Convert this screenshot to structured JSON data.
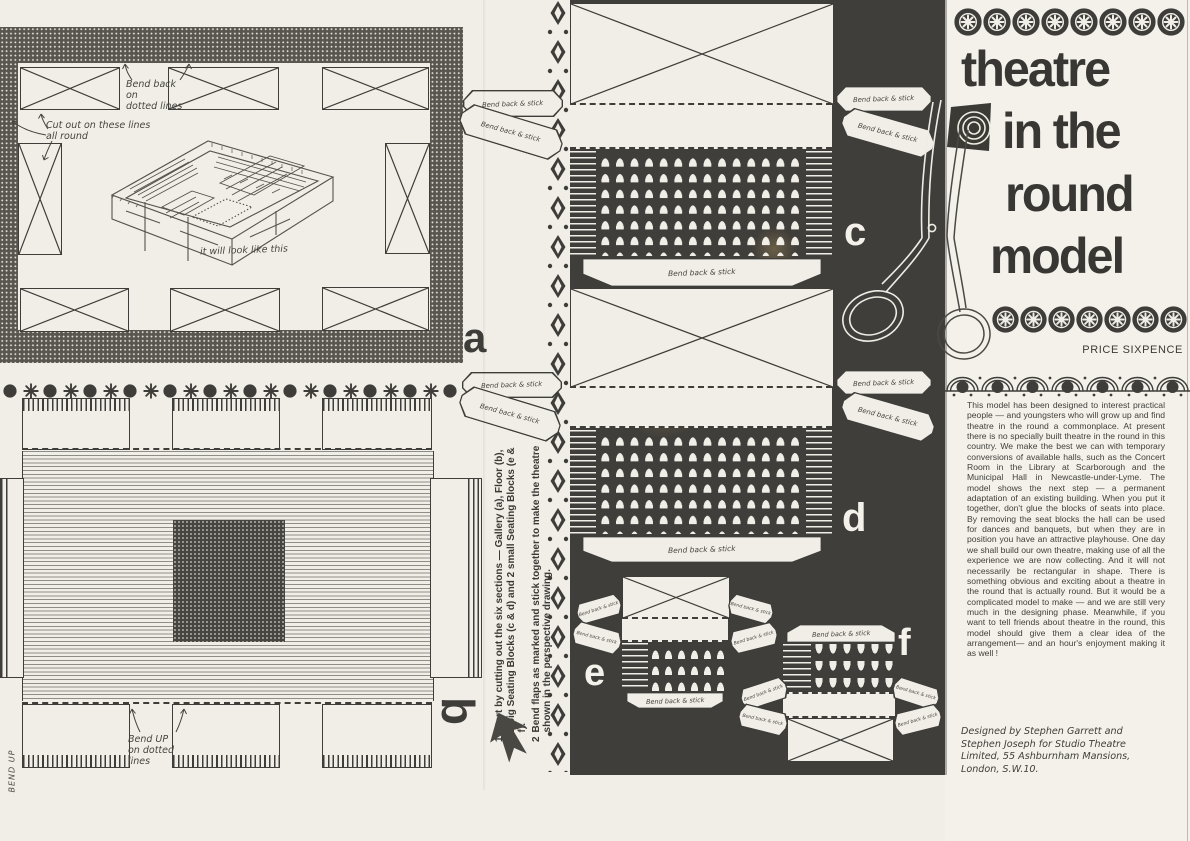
{
  "title_panel": {
    "title_lines": [
      "theatre",
      "in the",
      "round",
      "model"
    ],
    "price": "PRICE SIXPENCE",
    "body": "This model has been designed to interest practical people — and youngsters who will grow up and find theatre in the round a commonplace.  At present there is no specially built theatre in the round in this country.   We make the best we can with temporary conversions of available halls, such as the Concert Room in the Library at Scarborough and the Municipal Hall in Newcastle-under-Lyme. The model shows the next step — a permanent adaptation of an existing building.   When you put it together, don't glue the blocks of seats into place. By removing the seat blocks the hall can be used for dances and banquets, but when they are in position you have an attractive playhouse.   One day we shall build our own theatre, making use of all the experience we are now collecting. And it will not necessarily be rectangular in shape.   There is something obvious and exciting about a theatre in the round that is actually round.   But it would be a complicated model to make — and we are still very much in the designing phase.  Meanwhile, if you want to tell friends about theatre in the round, this model should give them a clear idea of the arrangement— and an hour's enjoyment making it as well !",
    "credits": "Designed by Stephen Garrett and Stephen Joseph for Studio Theatre Limited, 55 Ashburnham Mansions, London, S.W.10."
  },
  "instructions": {
    "step1_num": "1",
    "step1": "Start by cutting out the six sections — Gallery (a), Floor (b), 2 big Seating Blocks (c & d) and 2 small Seating Blocks (e & f).",
    "step2_num": "2",
    "step2": "Bend flaps as marked and stick together to make the theatre shown in the perspective drawing."
  },
  "annotations": {
    "bend_back_dotted": "Bend back\non\ndotted lines",
    "cut_out": "Cut out on these lines\nall round",
    "look_like": "it will look like this",
    "bend_up": "Bend UP\non dotted\nlines",
    "bend_up_edge": "BEND UP",
    "flap": "Bend back & stick"
  },
  "piece_labels": {
    "a": "a",
    "b": "b",
    "c": "c",
    "d": "d",
    "e": "e",
    "f": "f"
  },
  "colors": {
    "paper": "#f1eee7",
    "ink": "#3e3d39",
    "black_panel": "#403e3a"
  }
}
